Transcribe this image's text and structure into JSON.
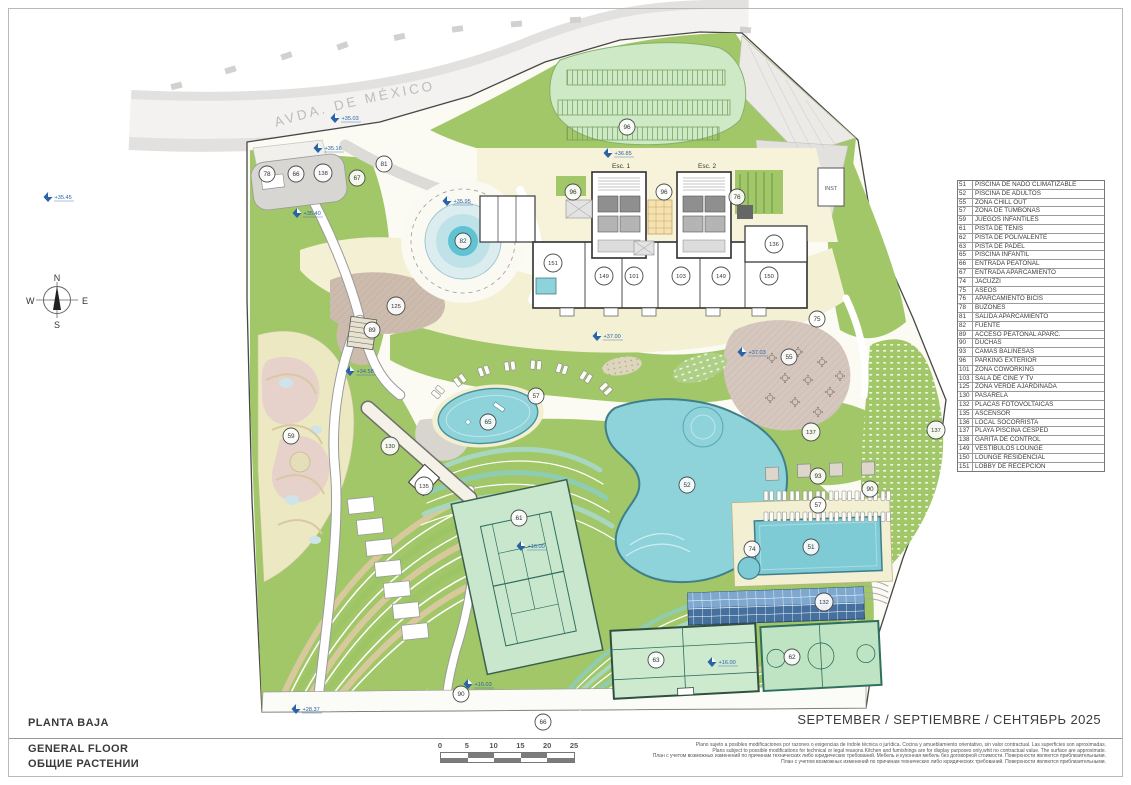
{
  "page": {
    "street_label": "AVDA. DE MÉXICO",
    "title_es": "PLANTA BAJA",
    "title_en": "GENERAL FLOOR",
    "title_ru": "ОБЩИЕ РАСТЕНИИ",
    "date_line": "SEPTEMBER / SEPTIEMBRE / СЕНТЯБРЬ 2025"
  },
  "compass": {
    "n": "N",
    "e": "E",
    "s": "S",
    "w": "W"
  },
  "building": {
    "esc1": "Esc. 1",
    "esc2": "Esc. 2",
    "inst": "INST"
  },
  "legend": {
    "items": [
      {
        "num": "51",
        "label": "PISCINA DE NADO CLIMATIZABLE"
      },
      {
        "num": "52",
        "label": "PISCINA DE ADULTOS"
      },
      {
        "num": "55",
        "label": "ZONA CHILL OUT"
      },
      {
        "num": "57",
        "label": "ZONA DE TUMBONAS"
      },
      {
        "num": "59",
        "label": "JUEGOS INFANTILES"
      },
      {
        "num": "61",
        "label": "PISTA DE TENIS"
      },
      {
        "num": "62",
        "label": "PISTA DE POLIVALENTE"
      },
      {
        "num": "63",
        "label": "PISTA DE PADEL"
      },
      {
        "num": "65",
        "label": "PISCINA INFANTIL"
      },
      {
        "num": "66",
        "label": "ENTRADA PEATONAL"
      },
      {
        "num": "67",
        "label": "ENTRADA APARCAMIENTO"
      },
      {
        "num": "74",
        "label": "JACUZZI"
      },
      {
        "num": "75",
        "label": "ASEOS"
      },
      {
        "num": "76",
        "label": "APARCAMIENTO BICIS"
      },
      {
        "num": "78",
        "label": "BUZONES"
      },
      {
        "num": "81",
        "label": "SALIDA APARCAMIENTO"
      },
      {
        "num": "82",
        "label": "FUENTE"
      },
      {
        "num": "89",
        "label": "ACCESO PEATONAL APARC."
      },
      {
        "num": "90",
        "label": "DUCHAS"
      },
      {
        "num": "93",
        "label": "CAMAS BALINESAS"
      },
      {
        "num": "96",
        "label": "PARKING EXTERIOR"
      },
      {
        "num": "101",
        "label": "ZONA COWORKING"
      },
      {
        "num": "103",
        "label": "SALA DE CINE Y TV"
      },
      {
        "num": "125",
        "label": "ZONA VERDE AJARDINADA"
      },
      {
        "num": "130",
        "label": "PASARELA"
      },
      {
        "num": "132",
        "label": "PLACAS FOTOVOLTAICAS"
      },
      {
        "num": "135",
        "label": "ASCENSOR"
      },
      {
        "num": "136",
        "label": "LOCAL SOCORRISTA"
      },
      {
        "num": "137",
        "label": "PLAYA PISCINA CESPED"
      },
      {
        "num": "138",
        "label": "GARITA DE CONTROL"
      },
      {
        "num": "149",
        "label": "VESTÍBULOS LOUNGE"
      },
      {
        "num": "150",
        "label": "LOUNGE RESIDENCIAL"
      },
      {
        "num": "151",
        "label": "LOBBY DE RECEPCIÓN"
      }
    ]
  },
  "scale_bar": {
    "ticks": [
      "0",
      "5",
      "10",
      "15",
      "20",
      "25"
    ]
  },
  "disclaimer": {
    "line_es": "Plano sujeto a posibles modificaciones por razones o exigencias de índole técnica o jurídica. Cocina y amueblamiento orientativo, sin valor contractual. Las superficies son aproximadas.",
    "line_en": "Plans subject to possible modifications for technical or legal reasons.Kitchen and furnishings are for display purposes only,whit no contractual value. The surface are approximate.",
    "line_ru": "План с учетом возможных изменений по причинам технических либо юридических требований. Мебель и кухонная мебель без договорной стоимости. Поверхности являются приблизительными.",
    "line_ru2": "План с учетом возможных изменений по причинам технических либо юридических требований. Поверхности являются приблизительными."
  },
  "markers": [
    {
      "num": "78",
      "x": 267,
      "y": 174
    },
    {
      "num": "66",
      "x": 296,
      "y": 174
    },
    {
      "num": "138",
      "x": 323,
      "y": 173
    },
    {
      "num": "67",
      "x": 357,
      "y": 178
    },
    {
      "num": "81",
      "x": 384,
      "y": 164
    },
    {
      "num": "82",
      "x": 463,
      "y": 241
    },
    {
      "num": "125",
      "x": 396,
      "y": 306
    },
    {
      "num": "89",
      "x": 372,
      "y": 330
    },
    {
      "num": "59",
      "x": 291,
      "y": 436
    },
    {
      "num": "130",
      "x": 390,
      "y": 446
    },
    {
      "num": "135",
      "x": 424,
      "y": 486
    },
    {
      "num": "96",
      "x": 627,
      "y": 127
    },
    {
      "num": "96",
      "x": 573,
      "y": 192
    },
    {
      "num": "96",
      "x": 664,
      "y": 192
    },
    {
      "num": "76",
      "x": 737,
      "y": 197
    },
    {
      "num": "136",
      "x": 774,
      "y": 244
    },
    {
      "num": "151",
      "x": 553,
      "y": 263
    },
    {
      "num": "149",
      "x": 604,
      "y": 276
    },
    {
      "num": "101",
      "x": 634,
      "y": 276
    },
    {
      "num": "103",
      "x": 681,
      "y": 276
    },
    {
      "num": "149",
      "x": 721,
      "y": 276
    },
    {
      "num": "150",
      "x": 769,
      "y": 276
    },
    {
      "num": "75",
      "x": 817,
      "y": 319
    },
    {
      "num": "55",
      "x": 789,
      "y": 357
    },
    {
      "num": "137",
      "x": 811,
      "y": 432
    },
    {
      "num": "137",
      "x": 936,
      "y": 430
    },
    {
      "num": "57",
      "x": 536,
      "y": 396
    },
    {
      "num": "65",
      "x": 488,
      "y": 422
    },
    {
      "num": "93",
      "x": 818,
      "y": 476
    },
    {
      "num": "57",
      "x": 818,
      "y": 505
    },
    {
      "num": "90",
      "x": 870,
      "y": 489
    },
    {
      "num": "52",
      "x": 687,
      "y": 485
    },
    {
      "num": "74",
      "x": 752,
      "y": 549
    },
    {
      "num": "51",
      "x": 811,
      "y": 547
    },
    {
      "num": "61",
      "x": 519,
      "y": 518
    },
    {
      "num": "132",
      "x": 824,
      "y": 602
    },
    {
      "num": "63",
      "x": 656,
      "y": 660
    },
    {
      "num": "62",
      "x": 792,
      "y": 657
    },
    {
      "num": "90",
      "x": 461,
      "y": 694
    },
    {
      "num": "66",
      "x": 543,
      "y": 722
    }
  ],
  "elevations": [
    {
      "text": "+35.03",
      "x": 335,
      "y": 118
    },
    {
      "text": "+35.16",
      "x": 318,
      "y": 148
    },
    {
      "text": "+35.45",
      "x": 48,
      "y": 197
    },
    {
      "text": "+35.40",
      "x": 297,
      "y": 213
    },
    {
      "text": "+35.95",
      "x": 447,
      "y": 201
    },
    {
      "text": "+36.85",
      "x": 608,
      "y": 153
    },
    {
      "text": "+37.00",
      "x": 597,
      "y": 336
    },
    {
      "text": "+37.03",
      "x": 742,
      "y": 352
    },
    {
      "text": "+34.58",
      "x": 350,
      "y": 371
    },
    {
      "text": "+16.00",
      "x": 521,
      "y": 546
    },
    {
      "text": "+16.00",
      "x": 712,
      "y": 662
    },
    {
      "text": "+16.03",
      "x": 468,
      "y": 684
    },
    {
      "text": "+28.37",
      "x": 296,
      "y": 709
    }
  ],
  "colors": {
    "water": "#8ed2da",
    "green": "#a2c768",
    "court_green": "#c9e7cd",
    "terrace_tan": "#d8c99d",
    "cream": "#f4f0d4",
    "solar_blue": "#46719f",
    "elevation_blue": "#2b63a8",
    "road_gray": "#e2e1df",
    "chillout_mauve": "#d5c6be"
  }
}
